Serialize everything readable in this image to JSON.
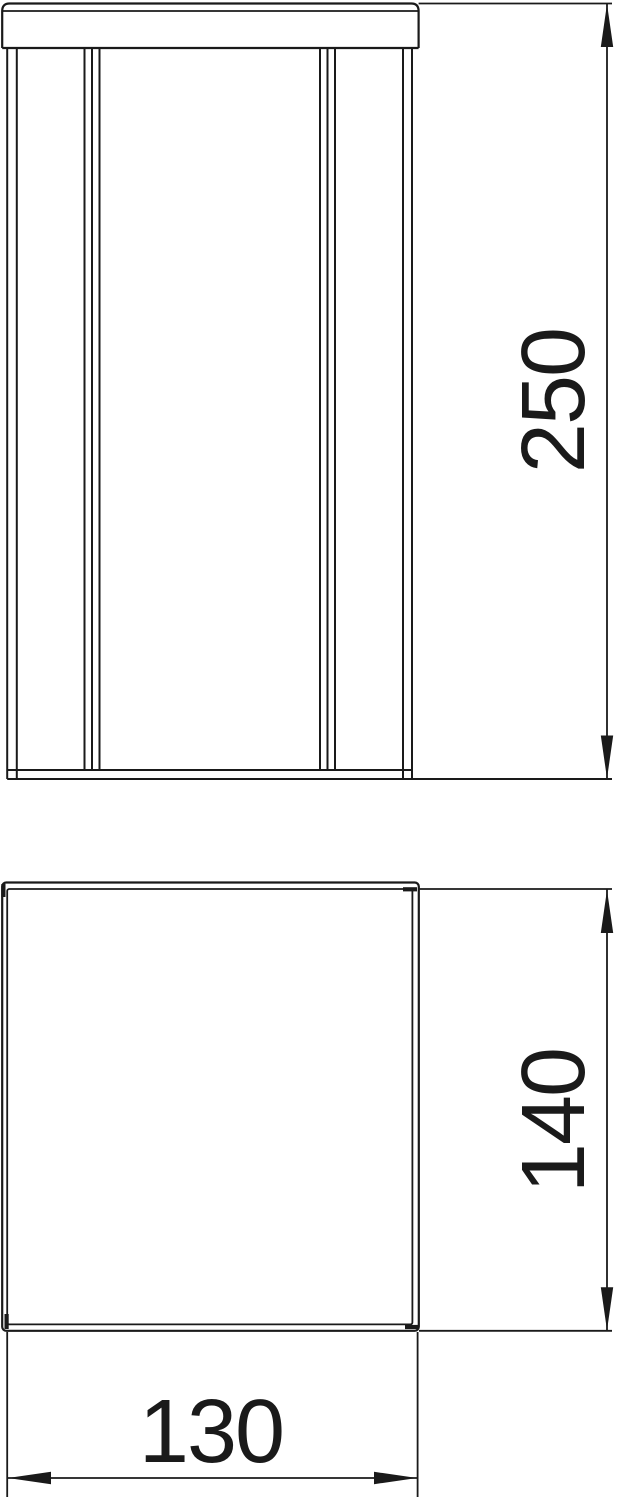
{
  "drawing": {
    "line_color": "#1a1a1a",
    "background_color": "#ffffff",
    "dimensions": {
      "height": {
        "value": "250"
      },
      "depth": {
        "value": "140"
      },
      "width": {
        "value": "130"
      }
    }
  }
}
